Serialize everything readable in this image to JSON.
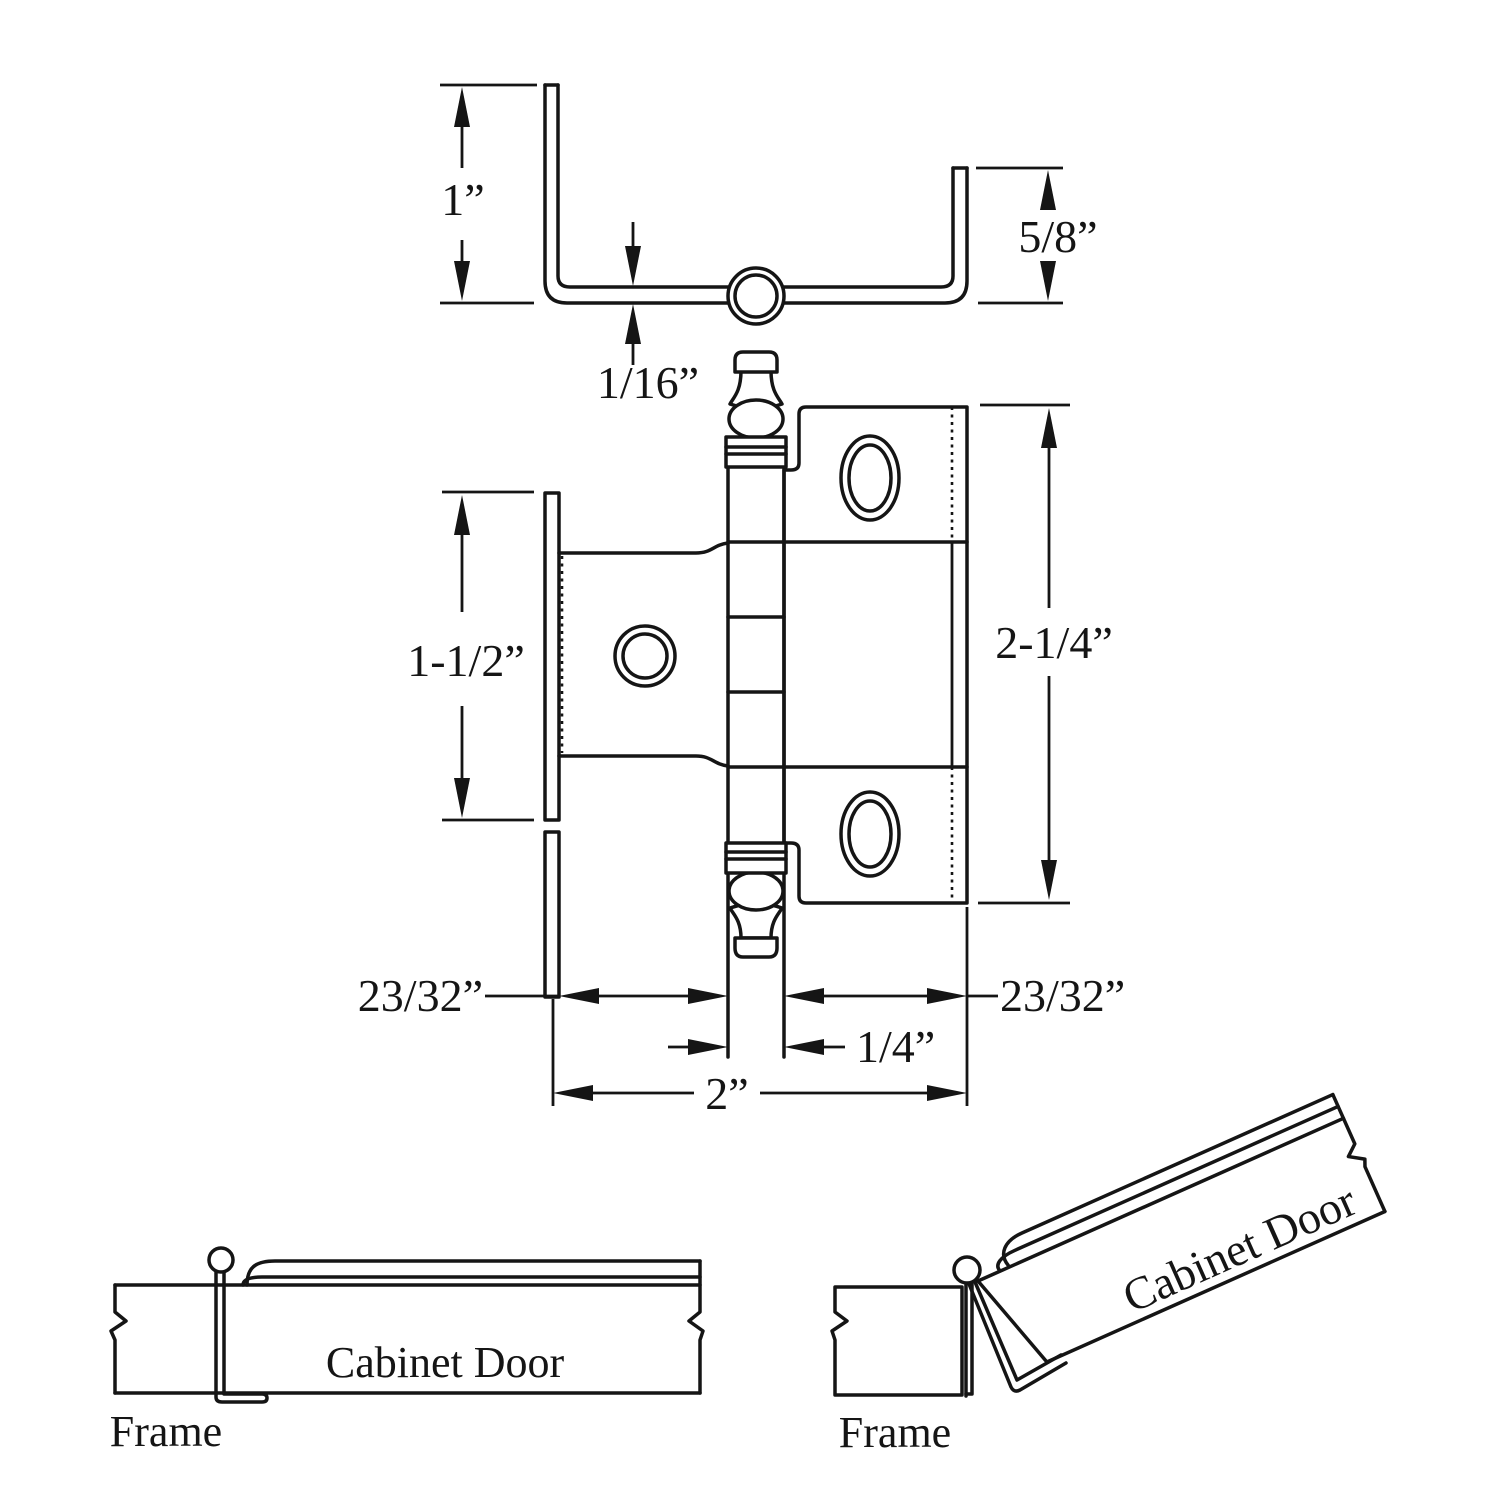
{
  "drawing": {
    "dims": {
      "leg_left": "1”",
      "leg_right": "5/8”",
      "thickness": "1/16”",
      "leaf_left_height": "1-1/2”",
      "leaf_right_height": "2-1/4”",
      "offset_left": "23/32”",
      "offset_right": "23/32”",
      "barrel_width": "1/4”",
      "total_width": "2”"
    },
    "closed_view": {
      "door": "Cabinet Door",
      "frame": "Frame"
    },
    "open_view": {
      "door": "Cabinet Door",
      "frame": "Frame"
    }
  }
}
